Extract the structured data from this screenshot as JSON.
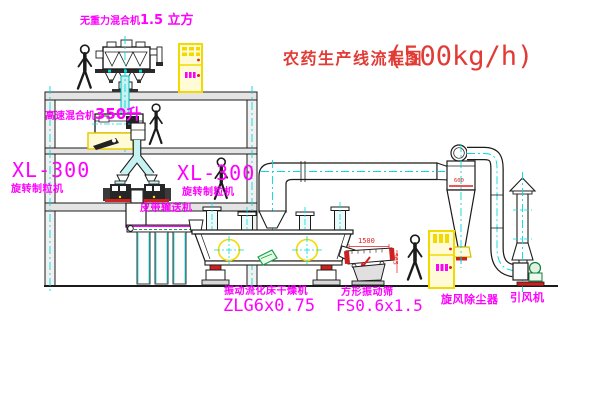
{
  "title": {
    "text": "农药生产线流程图",
    "capacity": "(500kg/h)"
  },
  "labels": {
    "gravity_mixer": {
      "name": "无重力混合机",
      "size": "1.5 立方"
    },
    "high_speed_mixer": {
      "name": "高速混合机",
      "size": "350升"
    },
    "granulator_left": {
      "model": "XL-300",
      "type": "旋转制粒机"
    },
    "granulator_right": {
      "model": "XL-300",
      "type": "旋转制粒机"
    },
    "belt_conveyor": "皮带输送机",
    "fluid_bed_dryer": {
      "name": "振动流化床干燥机",
      "model": "ZLG6x0.75"
    },
    "vibrating_screen": {
      "name": "方形振动筛",
      "model": "FS0.6x1.5"
    },
    "cyclone": "旋风除尘器",
    "induced_draft_fan": "引风机"
  },
  "dimensions": {
    "screen_length": "1500",
    "screen_side": "565",
    "cyclone_mark": "600"
  },
  "colors": {
    "label_magenta": "#ff00ff",
    "annotation_red": "#e02020",
    "pipe_cyan": "#00dcdc",
    "cabinet_yellow": "#f2d900",
    "machine_green": "#18a44c"
  }
}
